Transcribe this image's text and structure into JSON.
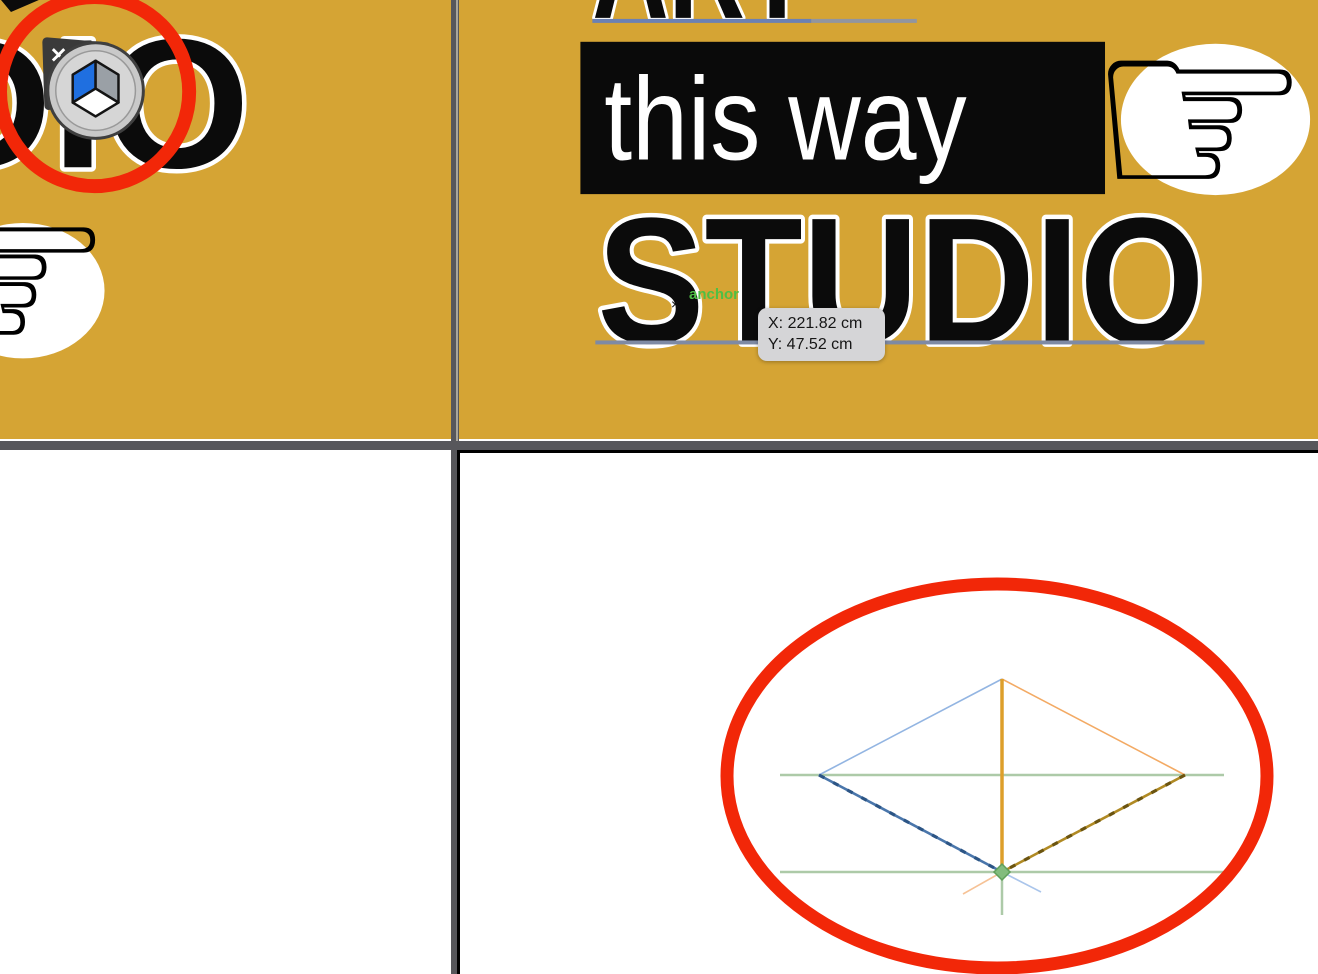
{
  "window": {
    "background": "#57575b"
  },
  "colors": {
    "artboard_gold": "#d5a434",
    "panel_white": "#ffffff",
    "poster_black": "#0a0a0a",
    "annotation_red": "#f22708",
    "baseline_blue": "#6b81b4",
    "baseline_gray": "#9195a0",
    "studio_baseline": "#7e8aa4",
    "divider_light_edge": "#a8a59c"
  },
  "poster_left": {
    "word_fragment": "DIO",
    "hand_glyph": "☞"
  },
  "poster_right": {
    "headline_top": "ART",
    "banner_text": "this way",
    "headline_bottom": "STUDIO",
    "hand_glyph": "☞"
  },
  "overlay": {
    "anchor_label": "anchor",
    "anchor_color": "#4fbf45",
    "cursor_mark": "×",
    "tooltip": {
      "line_x": "X: 221.82 cm",
      "line_y": "Y: 47.52 cm",
      "background": "#d5d5d7"
    }
  },
  "cube_badge": {
    "close_glyph": "✕",
    "tab_color": "#3a3a3a",
    "ring_fill": "#c9c9c9",
    "ring_stroke": "#3f3f3f",
    "inner_fill": "#d6d6d6",
    "face_left_color": "#1f6fe0",
    "face_right_color": "#9aa0a6",
    "face_bottom_color": "#ffffff",
    "edge_color": "#141414"
  },
  "annotations": {
    "color": "#f22708",
    "circle": {
      "cx": 94,
      "cy": 92,
      "r": 95,
      "stroke_width": 14
    },
    "ellipse": {
      "cx": 537,
      "cy": 323,
      "rx": 270,
      "ry": 192,
      "stroke_width": 13
    }
  },
  "figure": {
    "lines": [
      {
        "name": "ground-line-upper",
        "x1": 320,
        "y1": 322,
        "x2": 764,
        "y2": 322,
        "color": "#adcaa8",
        "w": 2.5
      },
      {
        "name": "ground-line-lower",
        "x1": 320,
        "y1": 419,
        "x2": 764,
        "y2": 419,
        "color": "#adcaa8",
        "w": 2.5
      },
      {
        "name": "vertical-green",
        "x1": 542,
        "y1": 406,
        "x2": 542,
        "y2": 462,
        "color": "#adcaa8",
        "w": 2.5
      },
      {
        "name": "edge-top-left",
        "x1": 542,
        "y1": 226,
        "x2": 359,
        "y2": 322,
        "color": "#93b5e2",
        "w": 1.6
      },
      {
        "name": "edge-top-right",
        "x1": 542,
        "y1": 226,
        "x2": 725,
        "y2": 322,
        "color": "#f3aa64",
        "w": 1.6
      },
      {
        "name": "axis-vertical",
        "x1": 542,
        "y1": 226,
        "x2": 542,
        "y2": 419,
        "color": "#dd9f2b",
        "w": 3.5
      },
      {
        "name": "edge-bottom-left-base",
        "x1": 359,
        "y1": 322,
        "x2": 542,
        "y2": 419,
        "color": "#4a76ab",
        "w": 2.6
      },
      {
        "name": "edge-bottom-left-ticks",
        "x1": 359,
        "y1": 322,
        "x2": 542,
        "y2": 419,
        "color": "#2c5585",
        "w": 3.2,
        "dash": "6 10"
      },
      {
        "name": "edge-bottom-right-base",
        "x1": 725,
        "y1": 322,
        "x2": 542,
        "y2": 419,
        "color": "#b08a24",
        "w": 2.6
      },
      {
        "name": "edge-bottom-right-ticks",
        "x1": 725,
        "y1": 322,
        "x2": 542,
        "y2": 419,
        "color": "#6b5410",
        "w": 3.2,
        "dash": "6 10"
      },
      {
        "name": "extension-orange",
        "x1": 542,
        "y1": 419,
        "x2": 503,
        "y2": 441,
        "color": "#f6c296",
        "w": 1.6
      },
      {
        "name": "extension-blue",
        "x1": 542,
        "y1": 419,
        "x2": 581,
        "y2": 439,
        "color": "#aac5eb",
        "w": 1.6
      }
    ],
    "marker": {
      "x": 542,
      "y": 419,
      "r": 8,
      "fill": "#82bc7d",
      "stroke": "#5f9f5a"
    }
  }
}
